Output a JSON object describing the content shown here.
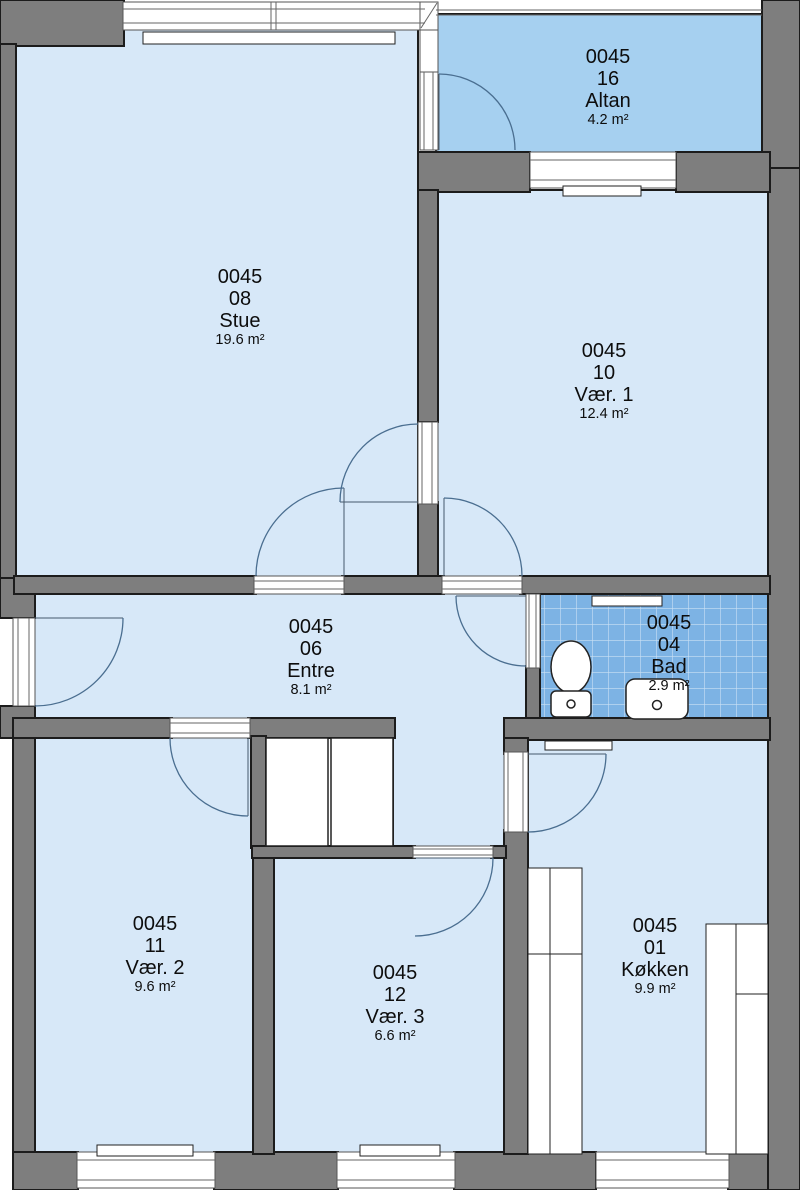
{
  "unit_code": "0045",
  "rooms": [
    {
      "code": "0045",
      "number": "16",
      "name": "Altan",
      "area": "4.2 m²"
    },
    {
      "code": "0045",
      "number": "08",
      "name": "Stue",
      "area": "19.6 m²"
    },
    {
      "code": "0045",
      "number": "10",
      "name": "Vær. 1",
      "area": "12.4 m²"
    },
    {
      "code": "0045",
      "number": "06",
      "name": "Entre",
      "area": "8.1 m²"
    },
    {
      "code": "0045",
      "number": "04",
      "name": "Bad",
      "area": "2.9 m²"
    },
    {
      "code": "0045",
      "number": "11",
      "name": "Vær. 2",
      "area": "9.6 m²"
    },
    {
      "code": "0045",
      "number": "12",
      "name": "Vær. 3",
      "area": "6.6 m²"
    },
    {
      "code": "0045",
      "number": "01",
      "name": "Køkken",
      "area": "9.9 m²"
    }
  ],
  "fixtures": [
    "toilet",
    "sink",
    "radiator",
    "wardrobe",
    "kitchen-counter",
    "shelf"
  ],
  "colors": {
    "room_fill": "#d7e8f8",
    "balcony_fill": "#a6d0f0",
    "tile_fill": "#7db3e4",
    "wall_fill": "#7e7e7e",
    "outline": "#1c1c1c",
    "door_arc": "#4a6e90"
  }
}
